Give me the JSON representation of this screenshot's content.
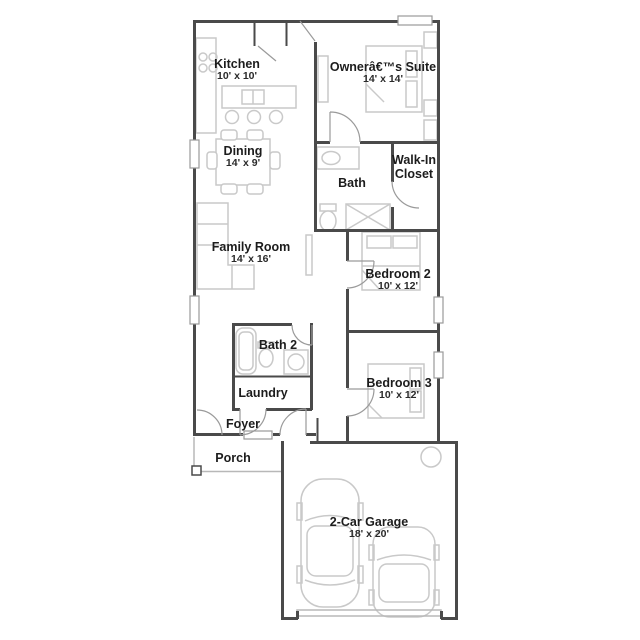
{
  "colors": {
    "wall": "#4a4a4a",
    "door": "#9a9a9a",
    "furniture": "#c9c9c9",
    "porch": "#b8b8b8",
    "label": "#1c1c1c"
  },
  "rooms": {
    "kitchen": {
      "name": "Kitchen",
      "dims": "10' x 10'"
    },
    "owners_suite": {
      "name": "Ownerâ€™s Suite",
      "dims": "14' x 14'"
    },
    "dining": {
      "name": "Dining",
      "dims": "14' x 9'"
    },
    "bath": {
      "name": "Bath",
      "dims": ""
    },
    "walk_in_closet": {
      "name": "Walk-In Closet",
      "dims": ""
    },
    "family_room": {
      "name": "Family Room",
      "dims": "14' x 16'"
    },
    "bedroom2": {
      "name": "Bedroom 2",
      "dims": "10' x 12'"
    },
    "bath2": {
      "name": "Bath 2",
      "dims": ""
    },
    "laundry": {
      "name": "Laundry",
      "dims": ""
    },
    "bedroom3": {
      "name": "Bedroom 3",
      "dims": "10' x 12'"
    },
    "foyer": {
      "name": "Foyer",
      "dims": ""
    },
    "porch": {
      "name": "Porch",
      "dims": ""
    },
    "garage": {
      "name": "2-Car Garage",
      "dims": "18' x 20'"
    }
  }
}
